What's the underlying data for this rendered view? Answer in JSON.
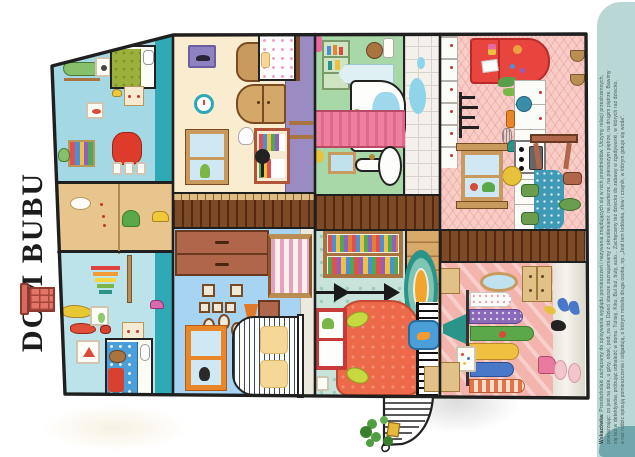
{
  "page": {
    "title": "DOM BUBU",
    "hint": {
      "label": "Wskazówka:",
      "lines": [
        "Przedszkolaki zachęcamy do opisywania wyglądu pomieszczeń i nazywania znajdujących się w nich przedmiotów. Uczymy relacji przestrzennych,",
        "powtarzając: co jest na dole, u góry, obok, pod, za itd. Dzieci starsze zaznajamiamy z określeniami: na parterze, na pierwszym piętrze, na drugim piętrze. Bawimy",
        "się też w detektywów, próbując odnaleźć w domu: Tulisię, Kiko, Bul bul, buty, auto... Zachęcamy też dziecko do zabawy w zgadywanki, w których raz dziecko,",
        "a raz rodzic opisują pomieszczenia i odgadują, o którym mówiła druga osoba, np. „Jest tam lodówka, zlew i czajnik, w którym gotuje się woda”."
      ]
    }
  },
  "scene": {
    "rooms": [
      {
        "id": "attic-kids-room",
        "wall": "#a3d8e4"
      },
      {
        "id": "attic-storage",
        "wall": "#e7c58d"
      },
      {
        "id": "attic-playroom",
        "wall": "#bde3ea"
      },
      {
        "id": "bedroom",
        "wall": "#faeccf"
      },
      {
        "id": "kids-bedroom",
        "wall": "#a6d4f2"
      },
      {
        "id": "bathroom",
        "wall": "#a9d8a8"
      },
      {
        "id": "living-room",
        "wall": "#c8e4da"
      },
      {
        "id": "kitchen",
        "wall": "#f8cdc8"
      },
      {
        "id": "hallway",
        "wall": "#f2b4ac"
      }
    ]
  },
  "palette": {
    "paper": "#ffffff",
    "outline": "#1f1f1f",
    "title": "#1c1c1c",
    "side_note_bg": "#b9d7d5",
    "side_note_curl": "#6fa7ad",
    "hint_text": "#4c5a58",
    "chimney_brick": "#e07568",
    "attic_floor_strip": "#2fa9b5",
    "floor_planks": "#7c4a26",
    "bedroom_accent_wall": "#9a8cc2",
    "fridge_red": "#e8453f",
    "bath_curtain_pink": "#ef7f9e",
    "armchair_orange": "#ec6a4a",
    "rug_teal": "#2a9488",
    "tablecloth_blue": "#3f9ab5",
    "wood": "#d4a868"
  }
}
